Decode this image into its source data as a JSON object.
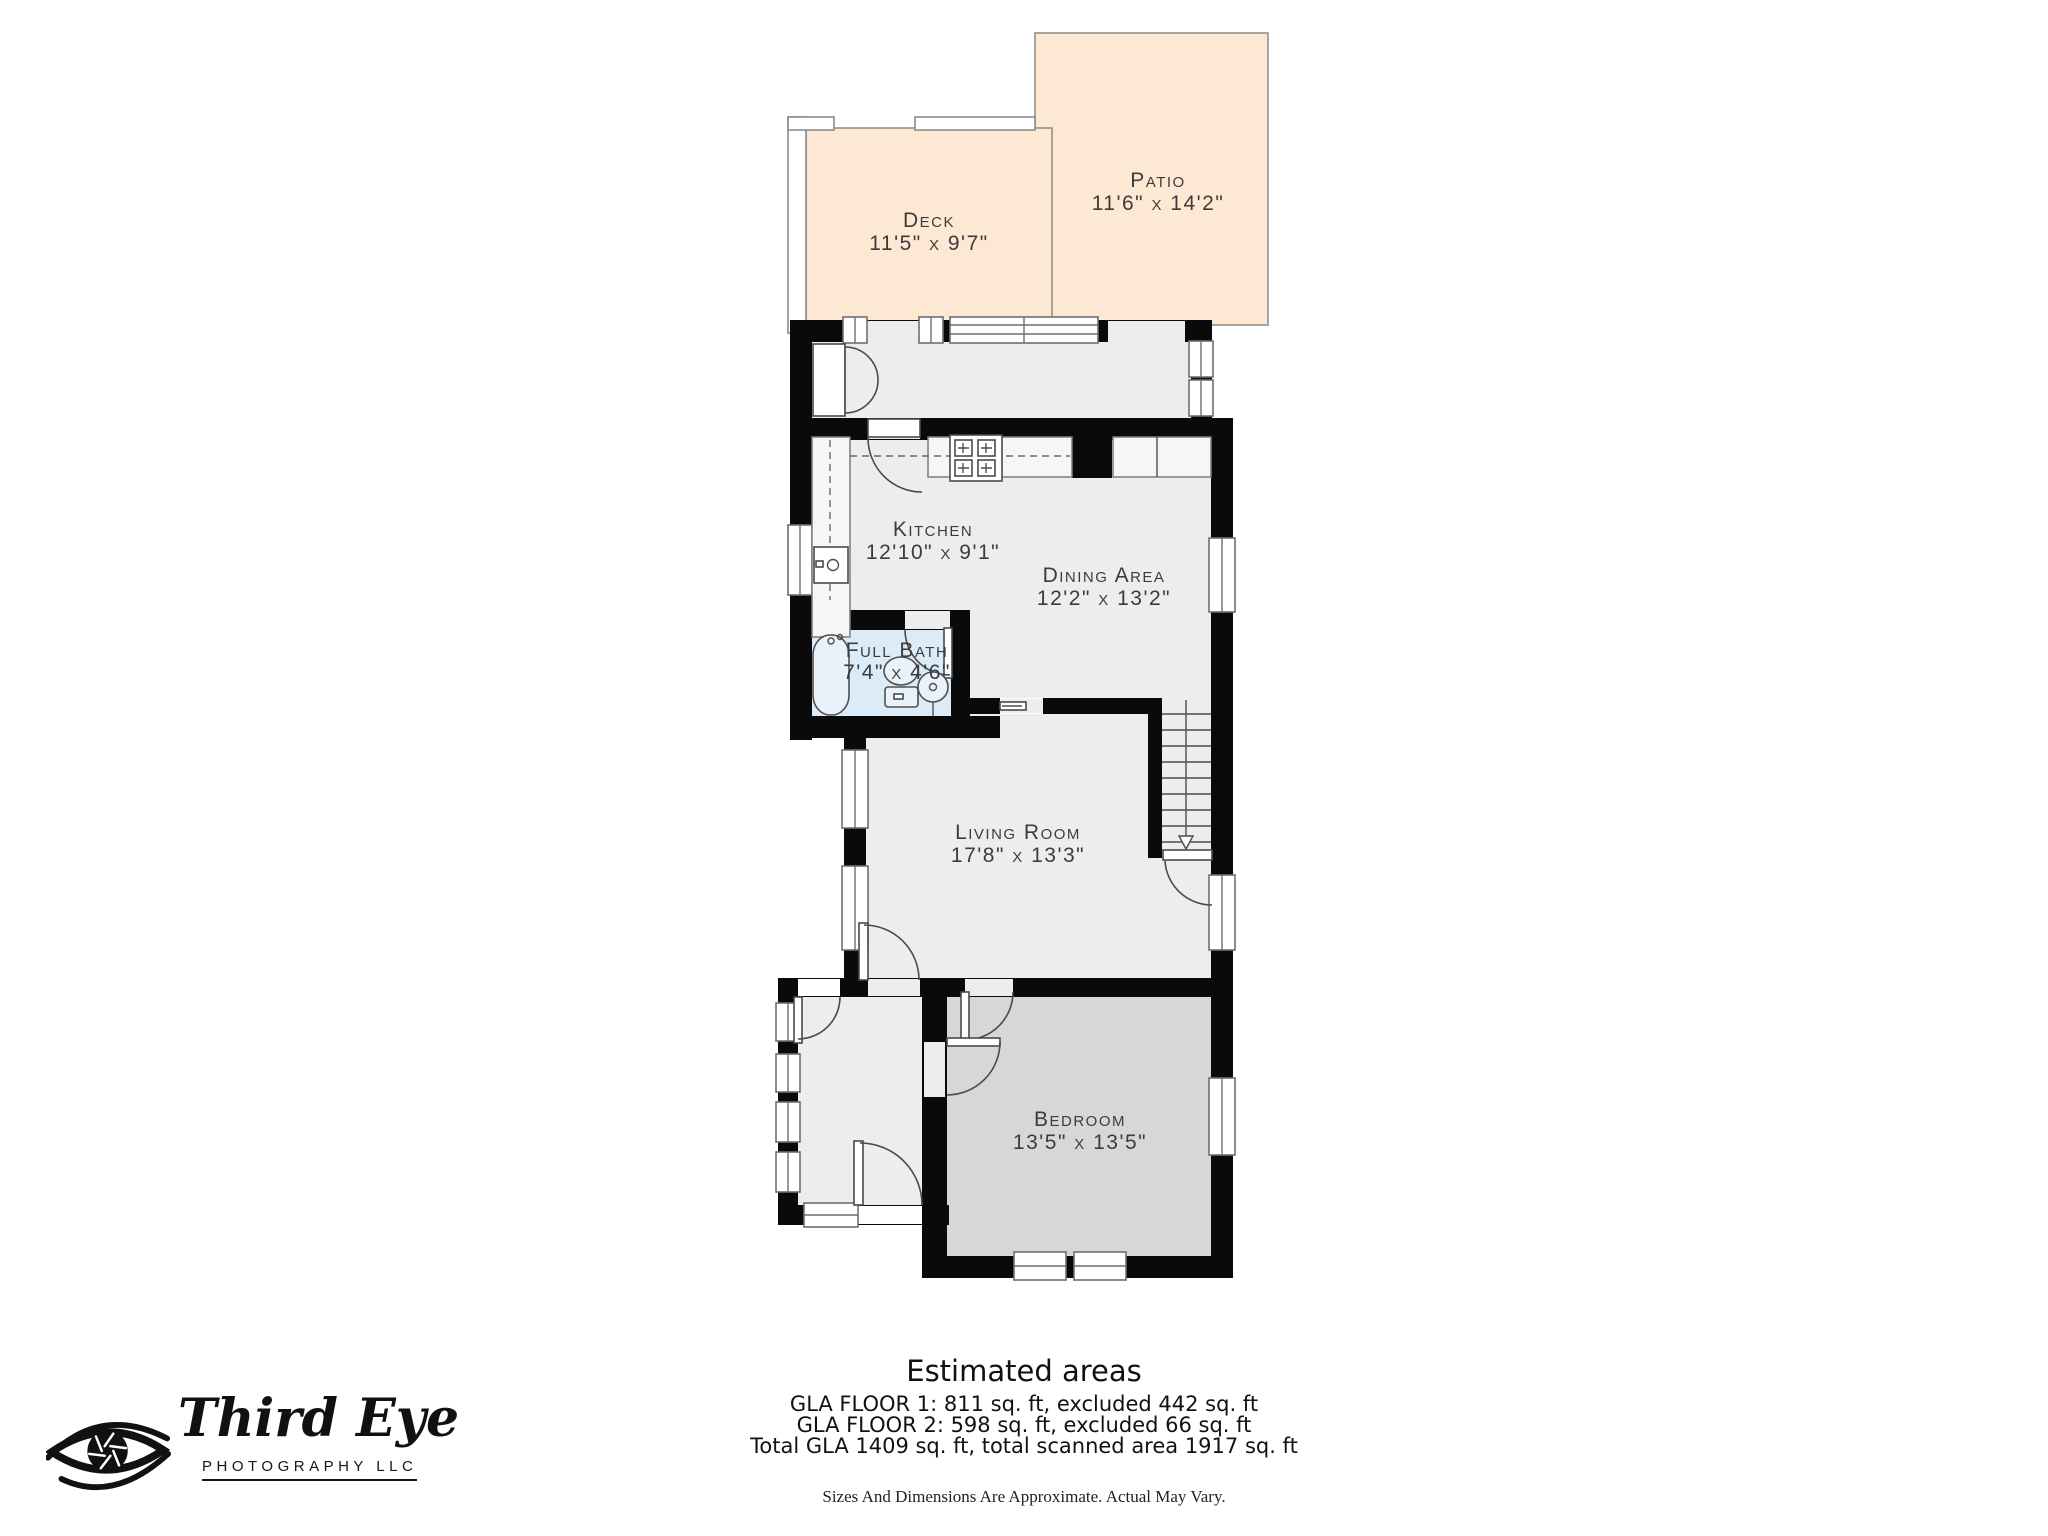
{
  "rooms": {
    "deck": {
      "name": "Deck",
      "dims": "11'5\" x 9'7\""
    },
    "patio": {
      "name": "Patio",
      "dims": "11'6\" x 14'2\""
    },
    "kitchen": {
      "name": "Kitchen",
      "dims": "12'10\" x 9'1\""
    },
    "dining": {
      "name": "Dining Area",
      "dims": "12'2\" x 13'2\""
    },
    "bath": {
      "name": "Full Bath",
      "dims": "7'4\" x 4'6\""
    },
    "living": {
      "name": "Living Room",
      "dims": "17'8\" x 13'3\""
    },
    "bedroom": {
      "name": "Bedroom",
      "dims": "13'5\" x 13'5\""
    }
  },
  "estimated_areas": {
    "title": "Estimated areas",
    "floor1": "GLA FLOOR 1: 811 sq. ft, excluded 442 sq. ft",
    "floor2": "GLA FLOOR 2: 598 sq. ft, excluded 66 sq. ft",
    "total": "Total GLA 1409 sq. ft, total scanned area 1917 sq. ft",
    "disclaimer": "Sizes And Dimensions Are Approximate. Actual May Vary."
  },
  "logo": {
    "brand": "Third Eye",
    "subtitle": "PHOTOGRAPHY LLC",
    "icon": "eye-aperture-logo"
  },
  "colors": {
    "outdoor_area": "#fce8d3",
    "floor": "#ededed",
    "bedroom_floor": "#d7d7d7",
    "bathroom": "#dcebf8",
    "wall": "#0a0a0a"
  }
}
